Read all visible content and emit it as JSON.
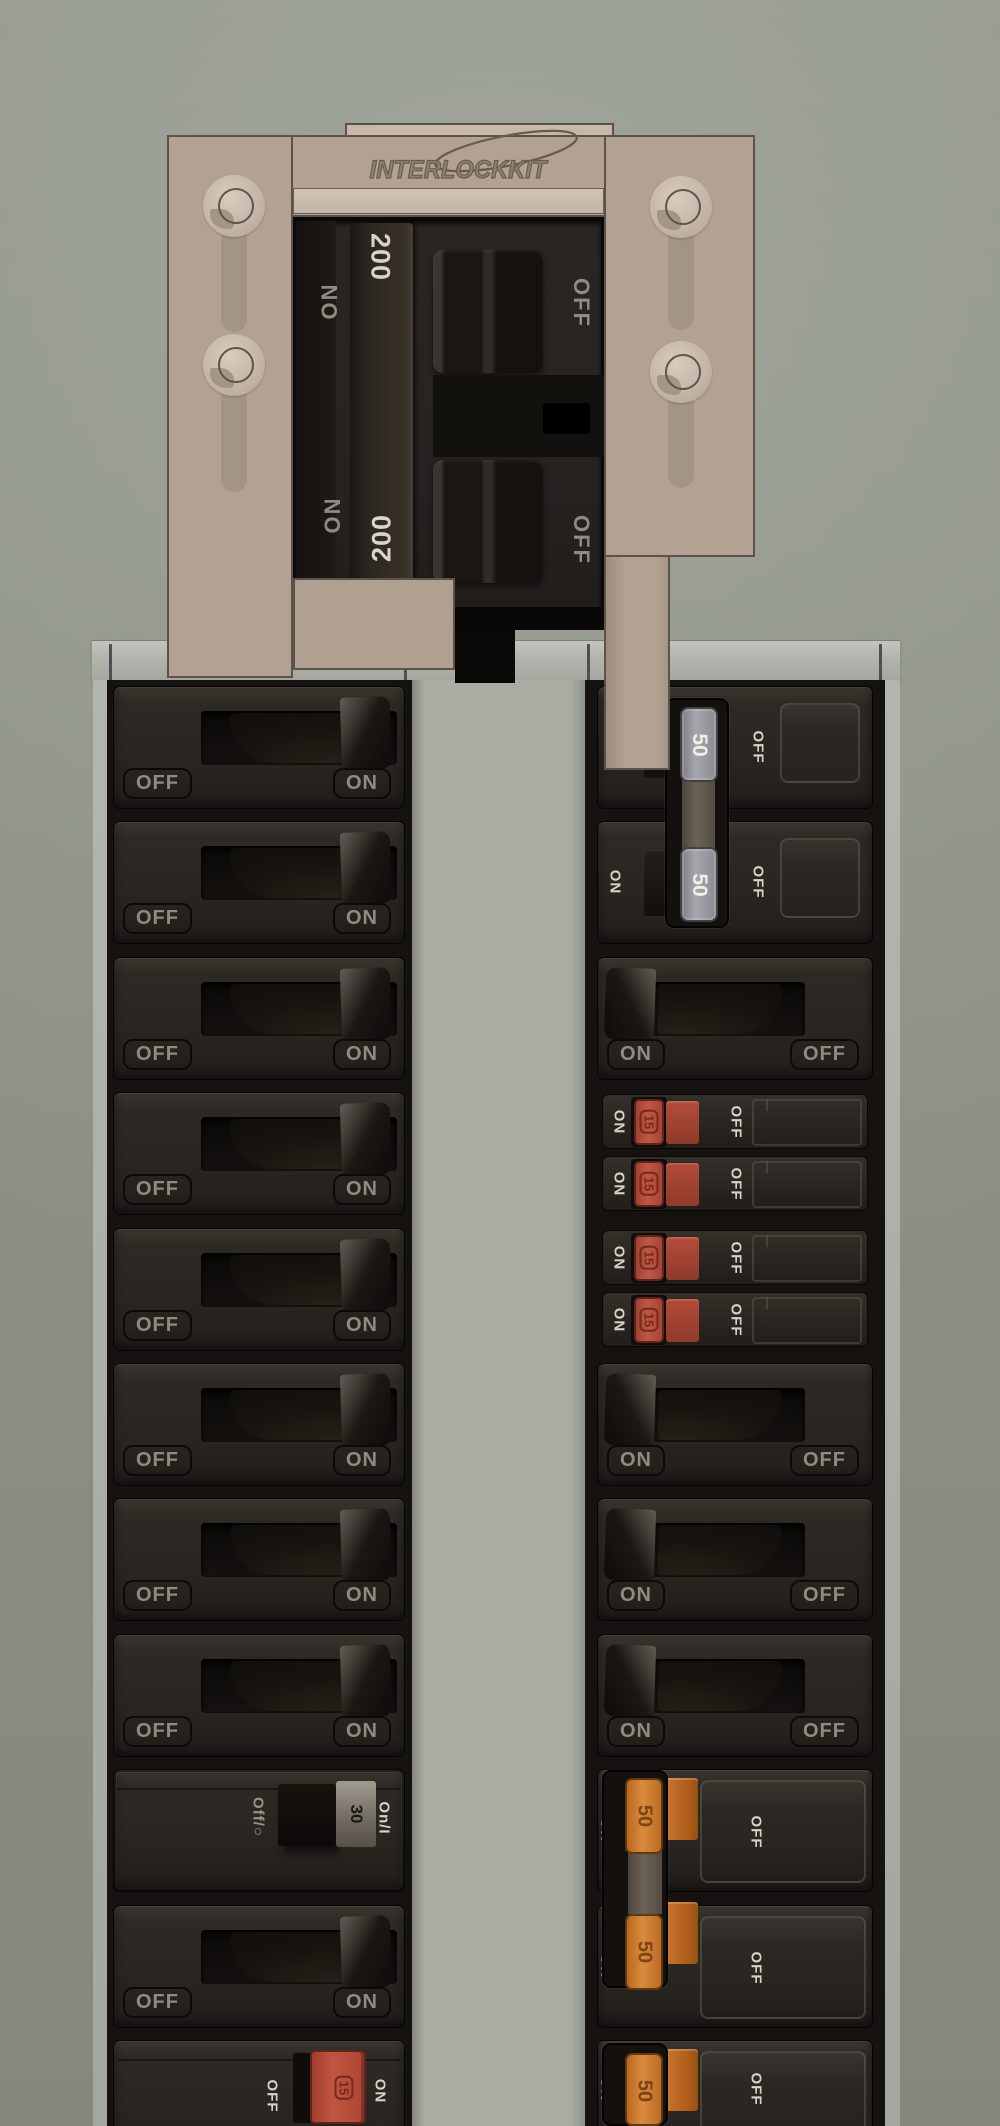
{
  "panel": {
    "interlock_plate": {
      "brand_logo": "INTERLOCKKIT"
    },
    "main_breaker": {
      "rating_top": "200",
      "rating_bottom": "200",
      "on_label": "ON",
      "off_label": "OFF"
    },
    "colors": {
      "plate_tan": "#b3a294",
      "handle_red": "#c05744",
      "handle_orange": "#cf7a33",
      "handle_gray": "#9b9ca1",
      "breaker_face": "#292521",
      "background": "#999e93"
    },
    "left_column": {
      "rows": [
        {
          "type": "standard",
          "off": "OFF",
          "on": "ON"
        },
        {
          "type": "standard",
          "off": "OFF",
          "on": "ON"
        },
        {
          "type": "standard",
          "off": "OFF",
          "on": "ON"
        },
        {
          "type": "standard",
          "off": "OFF",
          "on": "ON"
        },
        {
          "type": "standard",
          "off": "OFF",
          "on": "ON"
        },
        {
          "type": "standard",
          "off": "OFF",
          "on": "ON"
        },
        {
          "type": "standard",
          "off": "OFF",
          "on": "ON"
        },
        {
          "type": "standard",
          "off": "OFF",
          "on": "ON"
        },
        {
          "type": "switch-30",
          "off": "Off/○",
          "amp": "30",
          "on": "On/I"
        },
        {
          "type": "standard",
          "off": "OFF",
          "on": "ON"
        },
        {
          "type": "breaker-15",
          "off": "OFF",
          "amp": "15",
          "on": "ON"
        }
      ]
    },
    "right_column": {
      "rows": [
        {
          "type": "double-50",
          "on": "ON",
          "amp": "50",
          "off": "OFF"
        },
        {
          "type": "double-50",
          "on": "ON",
          "amp": "50",
          "off": "OFF"
        },
        {
          "type": "standard",
          "on": "ON",
          "off": "OFF"
        },
        {
          "type": "tandem",
          "subs": [
            {
              "on": "ON",
              "amp": "15",
              "off": "OFF"
            },
            {
              "on": "ON",
              "amp": "15",
              "off": "OFF"
            }
          ]
        },
        {
          "type": "tandem",
          "subs": [
            {
              "on": "ON",
              "amp": "15",
              "off": "OFF"
            },
            {
              "on": "ON",
              "amp": "15",
              "off": "OFF"
            }
          ]
        },
        {
          "type": "standard",
          "on": "ON",
          "off": "OFF"
        },
        {
          "type": "standard",
          "on": "ON",
          "off": "OFF"
        },
        {
          "type": "standard",
          "on": "ON",
          "off": "OFF"
        },
        {
          "type": "double-50-orange",
          "on": "ON",
          "amp": "50",
          "off": "OFF"
        },
        {
          "type": "double-50-orange",
          "on": "ON",
          "amp": "50",
          "off": "OFF"
        },
        {
          "type": "double-50-orange",
          "on": "ON",
          "amp": "50",
          "off": "OFF"
        }
      ]
    }
  }
}
